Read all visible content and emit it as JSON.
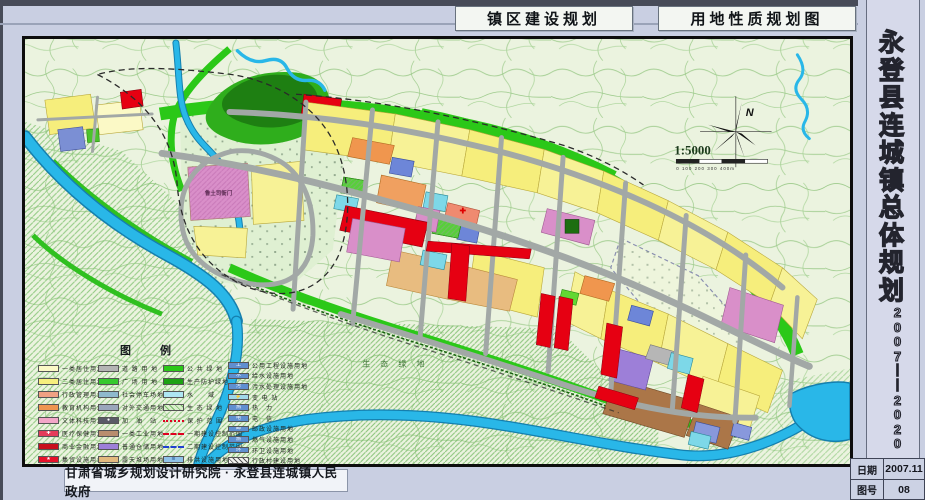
{
  "header": {
    "title_left": "镇区建设规划",
    "title_right": "用地性质规划图"
  },
  "sidebar": {
    "title_text": "永登县连城镇总体规划",
    "years_text": "2007——2020",
    "info_rows": [
      {
        "label": "日期",
        "value": "2007.11"
      },
      {
        "label": "图号",
        "value": "08"
      }
    ]
  },
  "footer": {
    "credit": "甘肃省城乡规划设计研究院 · 永登县连城镇人民政府"
  },
  "map": {
    "scale_text": "1:5000",
    "north_label": "N",
    "scale_bar_text": "0   100   200   300   400m",
    "labels": [
      {
        "text": "鲁土司衙门"
      },
      {
        "text": "生 态 绿 地"
      }
    ]
  },
  "legend": {
    "title": "图　例",
    "columns": [
      [
        {
          "label": "一类居住用地",
          "sw": {
            "type": "solid",
            "bg": "#fbf9c6"
          }
        },
        {
          "label": "二类居住用地",
          "sw": {
            "type": "solid",
            "bg": "#f6ee7c"
          }
        },
        {
          "label": "行政管理用地",
          "sw": {
            "type": "solid",
            "bg": "#f0a183"
          }
        },
        {
          "label": "教育机构用地",
          "sw": {
            "type": "solid",
            "bg": "#ee9550"
          }
        },
        {
          "label": "文体科技用地",
          "sw": {
            "type": "solid",
            "bg": "#f2a7c8"
          }
        },
        {
          "label": "医疗保健用地",
          "sw": {
            "type": "solid",
            "bg": "#e43c5a",
            "glyph": "✚",
            "glyphColor": "#fff"
          }
        },
        {
          "label": "商业金融用地",
          "sw": {
            "type": "solid",
            "bg": "#c80f1e"
          }
        },
        {
          "label": "集贸设施用地",
          "sw": {
            "type": "solid",
            "bg": "#e6132a",
            "glyph": "★",
            "glyphColor": "#fff"
          }
        }
      ],
      [
        {
          "label": "道 路 用 地",
          "sw": {
            "type": "solid",
            "bg": "#b4b4b4"
          }
        },
        {
          "label": "广 场 用 地",
          "sw": {
            "type": "solid",
            "bg": "#35c92e"
          }
        },
        {
          "label": "社会停车场地",
          "sw": {
            "type": "solid",
            "bg": "#8fb9cd"
          }
        },
        {
          "label": "对外交通用地",
          "sw": {
            "type": "solid",
            "bg": "#9aa6bb"
          }
        },
        {
          "label": "加　油　站",
          "sw": {
            "type": "solid",
            "bg": "#5a5a66",
            "glyph": "●",
            "glyphColor": "#fff"
          }
        },
        {
          "label": "一类工业用地",
          "sw": {
            "type": "solid",
            "bg": "#b98d6e"
          }
        },
        {
          "label": "普通仓储用地",
          "sw": {
            "type": "solid",
            "bg": "#9d7fd8"
          }
        },
        {
          "label": "露天堆场用地",
          "sw": {
            "type": "solid",
            "bg": "#e2b97e"
          }
        }
      ],
      [
        {
          "label": "公 共 绿 地",
          "sw": {
            "type": "solid",
            "bg": "#2bc818"
          }
        },
        {
          "label": "生产防护绿地",
          "sw": {
            "type": "solid",
            "bg": "#1da214"
          }
        },
        {
          "label": "水　　域",
          "sw": {
            "type": "solid",
            "bg": "#aee6f2"
          }
        },
        {
          "label": "生 态 绿 地",
          "sw": {
            "type": "hatch",
            "bg": "#d9eecb"
          }
        },
        {
          "label": "保 护 范 围",
          "sw": {
            "type": "dashdotred"
          }
        },
        {
          "label": "一期建设控制范围",
          "sw": {
            "type": "dashred"
          }
        },
        {
          "label": "二期建设控制范围",
          "sw": {
            "type": "dashblue"
          }
        },
        {
          "label": "排洪设施用地",
          "sw": {
            "type": "solid",
            "bg": "#8fc2e8",
            "glyph": "≋",
            "glyphColor": "#1a4a8a"
          }
        }
      ],
      [
        {
          "label": "公用工程设施用地",
          "sw": {
            "type": "solid",
            "bg": "#5f8fd0",
            "glyph": "工",
            "glyphColor": "#fff"
          }
        },
        {
          "label": "给水设施用地",
          "sw": {
            "type": "solid",
            "bg": "#5f8fd0",
            "glyph": "水",
            "glyphColor": "#fff"
          }
        },
        {
          "label": "污水处理设施用地",
          "sw": {
            "type": "solid",
            "bg": "#5f8fd0",
            "glyph": "污",
            "glyphColor": "#fff"
          }
        },
        {
          "label": "变 电 站",
          "sw": {
            "type": "solid",
            "bg": "#9fd8e8",
            "glyph": "⚡",
            "glyphColor": "#d00000"
          }
        },
        {
          "label": "热　力",
          "sw": {
            "type": "solid",
            "bg": "#5f8fd0",
            "glyph": "热",
            "glyphColor": "#fff"
          }
        },
        {
          "label": "电　信",
          "sw": {
            "type": "solid",
            "bg": "#5f8fd0",
            "glyph": "电",
            "glyphColor": "#fff"
          }
        },
        {
          "label": "邮政设施用地",
          "sw": {
            "type": "solid",
            "bg": "#5f8fd0",
            "glyph": "邮",
            "glyphColor": "#fff"
          }
        },
        {
          "label": "燃气设施用地",
          "sw": {
            "type": "solid",
            "bg": "#5f8fd0",
            "glyph": "燃",
            "glyphColor": "#fff"
          }
        },
        {
          "label": "环卫设施用地",
          "sw": {
            "type": "solid",
            "bg": "#5f8fd0",
            "glyph": "环",
            "glyphColor": "#fff"
          }
        },
        {
          "label": "行政村建设用地",
          "sw": {
            "type": "hatchw",
            "bg": "#f4f4f0"
          }
        }
      ]
    ]
  }
}
